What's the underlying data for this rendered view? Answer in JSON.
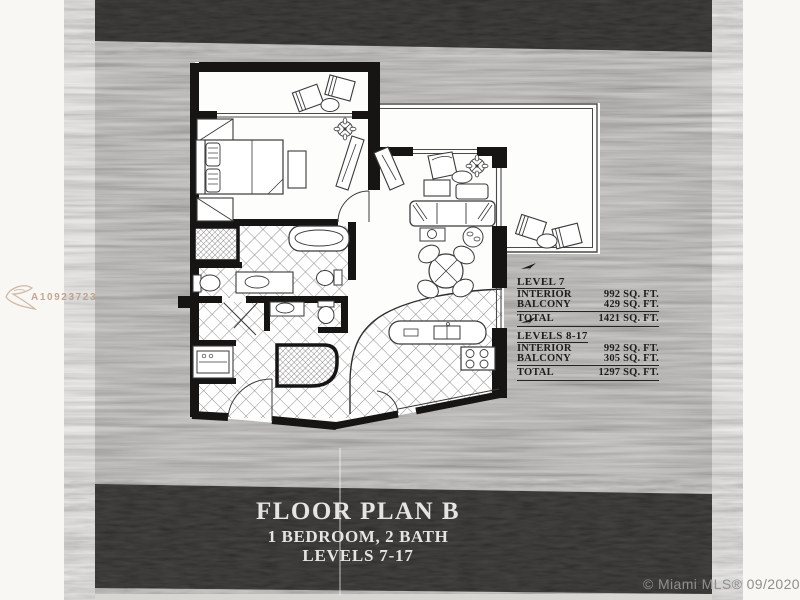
{
  "watermarks": {
    "listing_id": "A10923723",
    "credit": "© Miami MLS® 09/2020"
  },
  "title_block": {
    "plan_name": "FLOOR PLAN B",
    "configuration": "1 BEDROOM, 2 BATH",
    "levels": "LEVELS 7-17"
  },
  "area_tables": [
    {
      "heading": "LEVEL 7",
      "rows": [
        {
          "label": "INTERIOR",
          "value": "992 SQ. FT."
        },
        {
          "label": "BALCONY",
          "value": "429 SQ. FT."
        },
        {
          "label": "TOTAL",
          "value": "1421 SQ. FT."
        }
      ]
    },
    {
      "heading": "LEVELS 8-17",
      "rows": [
        {
          "label": "INTERIOR",
          "value": "992 SQ. FT."
        },
        {
          "label": "BALCONY",
          "value": "305 SQ. FT."
        },
        {
          "label": "TOTAL",
          "value": "1297 SQ. FT."
        }
      ]
    }
  ],
  "icons": {
    "north_arrow": "north-arrow-icon"
  },
  "colors": {
    "band_dark": "#1c1b19",
    "paper_gray": "#b4b2ad",
    "ink": "#1a1a1a",
    "title_text": "#e5e4e0",
    "credit_text": "#8f8f8d",
    "watermark_text": "#ba9882"
  }
}
